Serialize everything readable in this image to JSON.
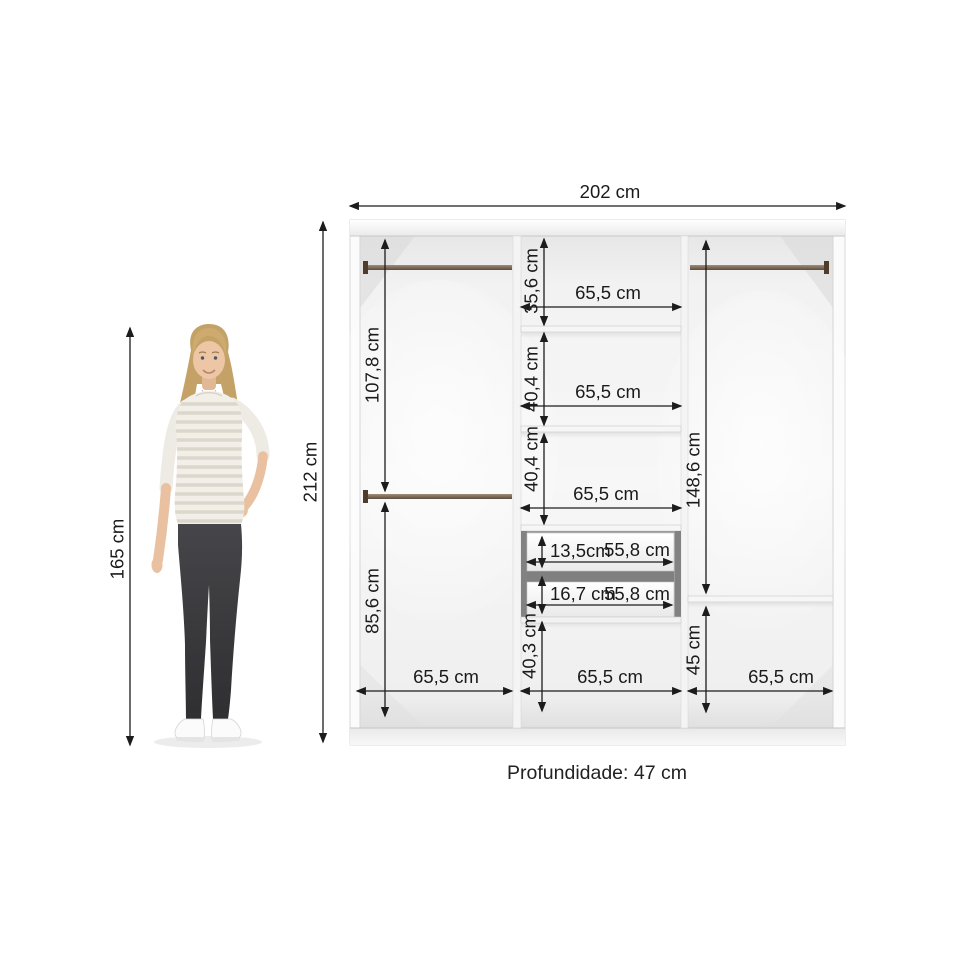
{
  "dims": {
    "overall_width": "202 cm",
    "overall_height": "212 cm",
    "person_height": "165 cm",
    "depth_note": "Profundidade: 47 cm",
    "left_upper_height": "107,8 cm",
    "left_lower_height": "85,6 cm",
    "left_width": "65,5 cm",
    "mid_top_height": "35,6 cm",
    "mid_top_width": "65,5 cm",
    "mid_second_height": "40,4 cm",
    "mid_second_width": "65,5 cm",
    "mid_third_height": "40,4 cm",
    "mid_third_width": "65,5 cm",
    "drawer1_height": "13,5cm",
    "drawer1_width": "55,8 cm",
    "drawer2_height": "16,7 cm",
    "drawer2_width": "55,8 cm",
    "mid_bottom_height": "40,3 cm",
    "mid_bottom_width": "65,5 cm",
    "right_upper_height": "148,6 cm",
    "right_lower_height": "45 cm",
    "right_width": "65,5 cm"
  },
  "colors": {
    "dimension_line": "#1c1c1c",
    "label_text": "#1a1a1a",
    "rod_brown": "#6e5a44",
    "bracket_brown": "#4f3c2a",
    "interior_light": "#f5f5f5",
    "drawer_gap_gray": "#8a8a8a"
  }
}
